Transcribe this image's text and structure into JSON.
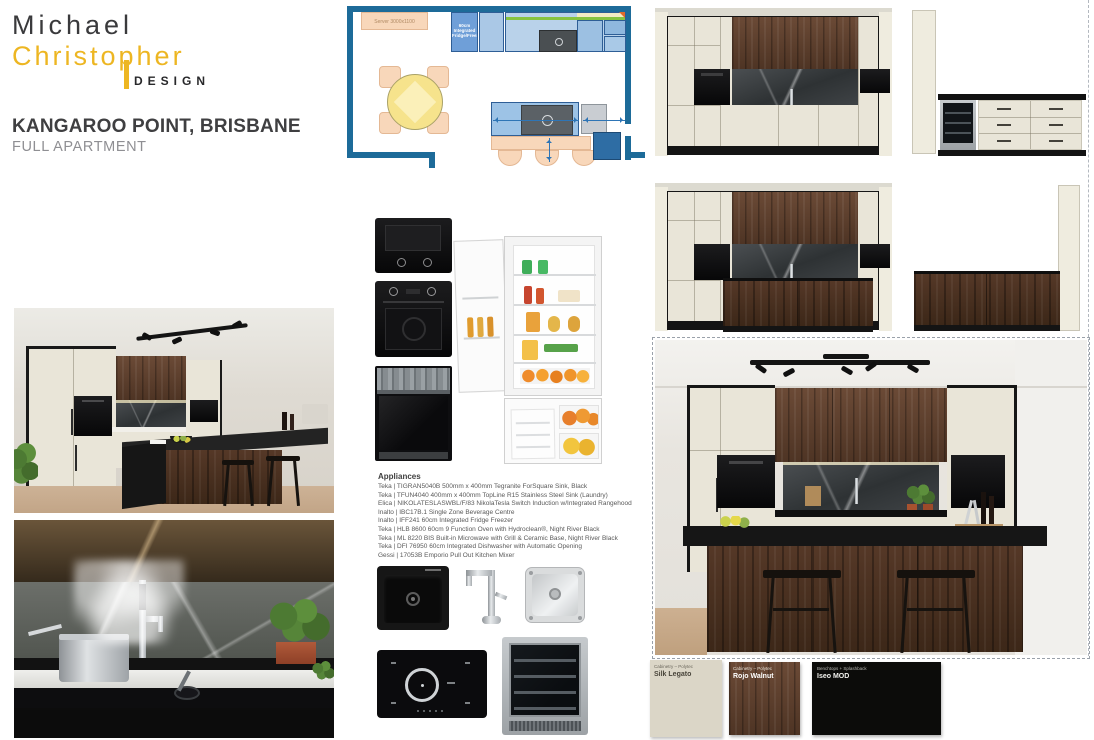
{
  "brand": {
    "line1": "Michael",
    "line2": "Christopher",
    "line3": "DESIGN"
  },
  "project": {
    "title": "KANGAROO POINT, BRISBANE",
    "subtitle": "FULL APARTMENT"
  },
  "floorplan": {
    "server_label": "Server 3000x1100",
    "fridge_label": "60cm Integrated Fridge/Freezer"
  },
  "appliances": {
    "heading": "Appliances",
    "items": [
      "Teka | TIGRAN5040B 500mm x 400mm Tegranite ForSquare Sink, Black",
      "Teka | TFUN4040 400mm x 400mm TopLine R15 Stainless Steel Sink (Laundry)",
      "Elica | NIKOLATESLASWBL/F/83 NikolaTesla Switch Induction w/Integrated Rangehood",
      "Inalto | IBC17B.1 Single Zone Beverage Centre",
      "Inalto | IFF241 60cm Integrated Fridge Freezer",
      "Teka | HLB 8600 60cm 9 Function Oven with Hydroclean®, Night River Black",
      "Teka | ML 8220 BIS Built-in Microwave with Grill & Ceramic Base, Night River Black",
      "Teka | DFI 76950 60cm Integrated Dishwasher with Automatic Opening",
      "Gessi | 17053B Emporio Pull Out Kitchen Mixer"
    ]
  },
  "swatches": [
    {
      "category": "Cabinetry – Polytec",
      "name": "Silk Legato",
      "color": "#dbd6c7"
    },
    {
      "category": "Cabinetry – Polytec",
      "name": "Rojo Walnut",
      "color": "#4a2f1f"
    },
    {
      "category": "Benchtops + Splashback",
      "name": "Iseo MOD",
      "color": "#0c0c0a"
    }
  ],
  "colors": {
    "accent_gold": "#edb622",
    "plan_wall_blue": "#1d6b99",
    "cabinet_cream": "#e9e5d8",
    "walnut": "#5a3c28"
  }
}
